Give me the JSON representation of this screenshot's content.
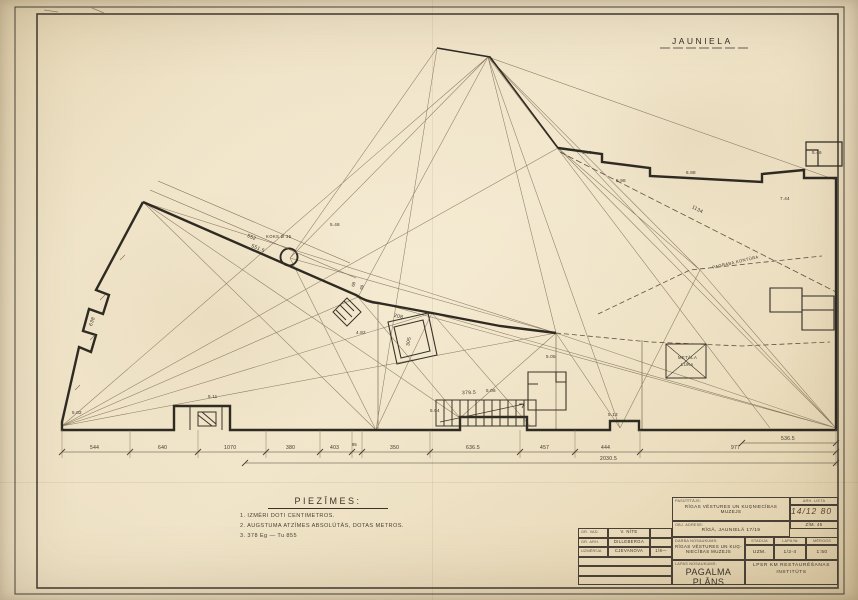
{
  "sheet": {
    "paper_color": "#ecdfc4",
    "ink_color": "#332d24",
    "thin_line_color": "#7a6a50",
    "street_label": "JAUNIELA"
  },
  "notes": {
    "title": "PIEZĪMES:",
    "lines": [
      "1. IZMĒRI DOTI CENTIMETROS.",
      "2. AUGSTUMA ATZĪMES ABSOLŪTĀS, DOTAS METROS.",
      "3. 378 Eg — Tu 855"
    ]
  },
  "plan": {
    "labels": {
      "basement_contour": "PAGRABA KONTŪRA",
      "metal_hatch_1": "METĀLA",
      "metal_hatch_2": "LŪKA",
      "tree": "KOKS Ø 35"
    },
    "dimensions": {
      "bottom_chain": [
        "544",
        "640",
        "1070",
        "380",
        "403",
        "85",
        "350",
        "636.5",
        "457",
        "444",
        "977"
      ],
      "upper_chain": "536.5",
      "overall": "2030.5",
      "diag_1134": "1134",
      "edge_552": "552",
      "edge_5515": "551.5",
      "edge_68": "68",
      "edge_69": "69",
      "stairs": "379.5",
      "dim_305": "305",
      "dim_208": "208",
      "dim_638": "638"
    },
    "elevations": [
      "5.02",
      "5.11",
      "5.48",
      "4.82",
      "5.06",
      "5.04",
      "5.05",
      "5.96",
      "5.98",
      "6.88",
      "7.44",
      "5.46",
      "5.13"
    ]
  },
  "titleblock": {
    "left_rows": [
      {
        "label": "GR. VAD.",
        "value": "V. NĪTE",
        "extra": ""
      },
      {
        "label": "GR. ARH.",
        "value": "DILLEBERGA",
        "extra": ""
      },
      {
        "label": "UZMĒRĪJA",
        "value": "CJEVANOVA",
        "extra": "1/8—"
      }
    ],
    "client_label": "PASŪTĪTĀJS:",
    "client_value_1": "RĪGAS VĒSTURES UN KUĢNIECĪBAS",
    "client_value_2": "MUZEJS",
    "address_label": "OBJ. ADRESE:",
    "address_value": "RĪGĀ, JAUNIELĀ 17/19",
    "work_label": "DARBA NOSAUKUMS:",
    "work_value_1": "RĪGAS VĒSTURES UN KUĢ-",
    "work_value_2": "NIECĪBAS MUZEJS",
    "sheet_label": "LAPAS NOSAUKUMS:",
    "sheet_value": "PAGALMA PLĀNS",
    "arch_header": "ARH. LIETA",
    "arch_date": "14/12 80",
    "arch_no": "ZĪM. 45",
    "stage_header": "STADIJA",
    "stage_value": "UZM.",
    "sheet_no_header": "LAPA №",
    "sheet_no_value": "1/2-4",
    "scale_header": "MĒROGS",
    "scale_value": "1:50",
    "institute": "LPSR KM RESTAURĒŠANAS INSTITŪTS"
  }
}
